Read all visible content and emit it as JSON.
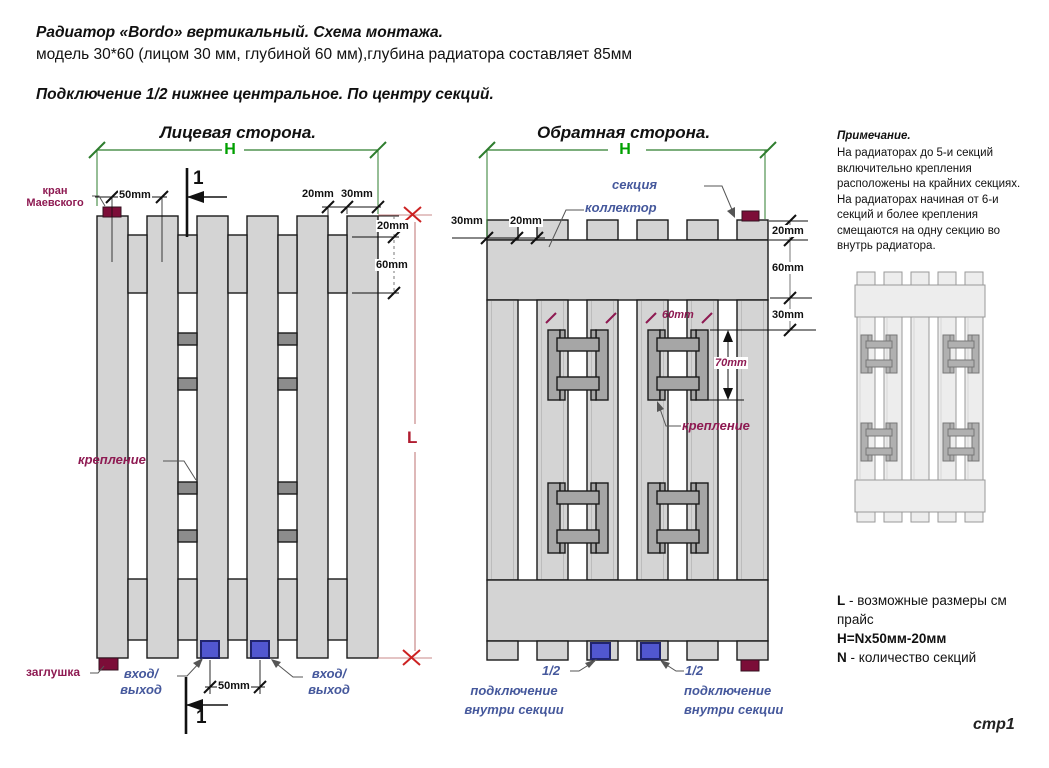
{
  "header": {
    "title": "Радиатор «Bordo» вертикальный. Схема монтажа.",
    "subtitle": "модель 30*60 (лицом 30 мм, глубиной 60 мм),глубина радиатора составляет 85мм",
    "connection_note": "Подключение 1/2 нижнее центральное. По центру секций."
  },
  "front_view": {
    "title": "Лицевая сторона.",
    "h_label": "H",
    "l_label": "L",
    "section_mark": "1",
    "labels": {
      "kran_line1": "кран",
      "kran_line2": "Маевского",
      "zaglushka": "заглушка",
      "kreplenie": "крепление",
      "vhod": "вход/",
      "vyhod": "выход"
    },
    "dims": {
      "top_50": "50mm",
      "top_20": "20mm",
      "top_30": "30mm",
      "right_20": "20mm",
      "right_60": "60mm",
      "bottom_50": "50mm"
    }
  },
  "back_view": {
    "title": "Обратная сторона.",
    "h_label": "H",
    "labels": {
      "sekciya": "секция",
      "kollektor": "коллектор",
      "kreplenie": "крепление",
      "half": "1/2",
      "podkluchenie": "подключение",
      "vnutri_sekcii": "внутри секции"
    },
    "dims": {
      "top_30": "30mm",
      "top_20": "20mm",
      "right_20": "20mm",
      "right_60": "60mm",
      "right_30": "30mm",
      "bracket_60": "60mm",
      "bracket_70": "70mm"
    }
  },
  "note": {
    "title": "Примечание.",
    "body": "На радиаторах до 5-и секций включительно крепления расположены на крайних секциях. На радиаторах начиная от 6-и секций и более крепления смещаются на одну секцию во внутрь радиатора."
  },
  "legend": {
    "l_key": "L",
    "l_text": "- возможные размеры см прайс",
    "formula": "H=Nx50мм-20мм",
    "n_key": "N",
    "n_text": "- количество секций"
  },
  "footer": {
    "page": "стр1"
  },
  "colors": {
    "tube_fill": "#d4d4d4",
    "outline": "#1a1a1a",
    "bracket_fill": "#a6a6a6",
    "rail_fill": "#8c8c8c",
    "maroon": "#7c0d38",
    "blue_fill": "#5157d0",
    "blue_border": "#20246e",
    "dim_green": "#2e7d2e",
    "green_label": "#00a000",
    "dim_red": "#c98989",
    "red_mark": "#cc2222",
    "red_label": "#b01c30",
    "magenta": "#8e1a52",
    "blue_label": "#45589c",
    "leader": "#555555",
    "mini_stroke": "#999999",
    "mini_fill": "#ededed",
    "mini_bracket": "#b0b0b0"
  }
}
